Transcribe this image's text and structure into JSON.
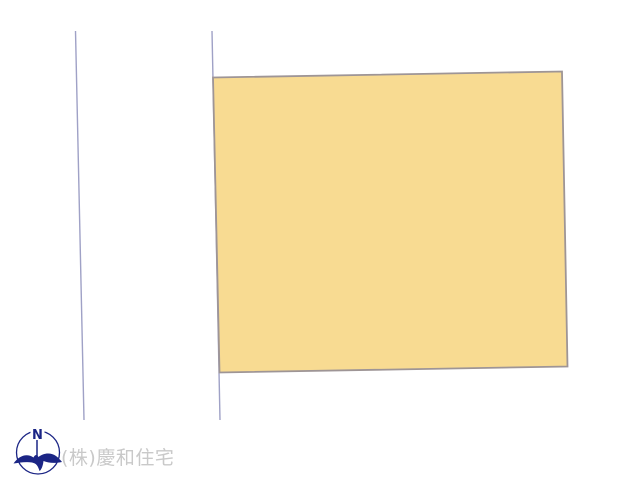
{
  "diagram": {
    "title": "land-plot-site-plan",
    "parcel": {
      "points": "213,77.5 562,71.5 567.5,366.5 219.5,372.5",
      "fill": "#f8db92",
      "stroke": "#9e9596"
    },
    "road_lines": [
      {
        "d": "M75.5,31 L84,420",
        "stroke": "#9fa1c6"
      },
      {
        "d": "M212,31 L220,420",
        "stroke": "#9fa1c6"
      }
    ]
  },
  "compass": {
    "label": "N",
    "color": "#1b2585"
  },
  "watermark": {
    "text": "(株)慶和住宅",
    "color": "#c9c9c9"
  }
}
